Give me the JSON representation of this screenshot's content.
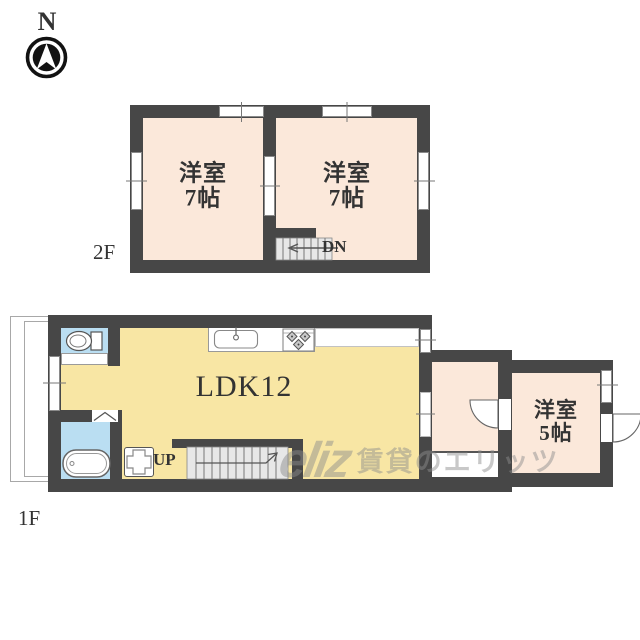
{
  "page": {
    "background": "#ffffff",
    "type": "floor-plan"
  },
  "colors": {
    "wall": "#474747",
    "peach": "#fbe8da",
    "yellow": "#f8e6a4",
    "blue": "#badef2",
    "stair": "#e7e7e7",
    "line": "#777777",
    "text": "#333333",
    "mark": "#8d8d8d"
  },
  "compass": {
    "north_label": "N"
  },
  "floor2": {
    "label": "2F",
    "room_left": {
      "line1": "洋室",
      "line2": "7帖"
    },
    "room_right": {
      "line1": "洋室",
      "line2": "7帖"
    },
    "stairs_label": "DN"
  },
  "floor1": {
    "label": "1F",
    "ldk_label": "LDK12",
    "stairs_label": "UP",
    "room_right": {
      "line1": "洋室",
      "line2": "5帖"
    }
  },
  "watermark": {
    "logo_text": "eliz",
    "brand_text": "賃貸のエリッツ"
  }
}
